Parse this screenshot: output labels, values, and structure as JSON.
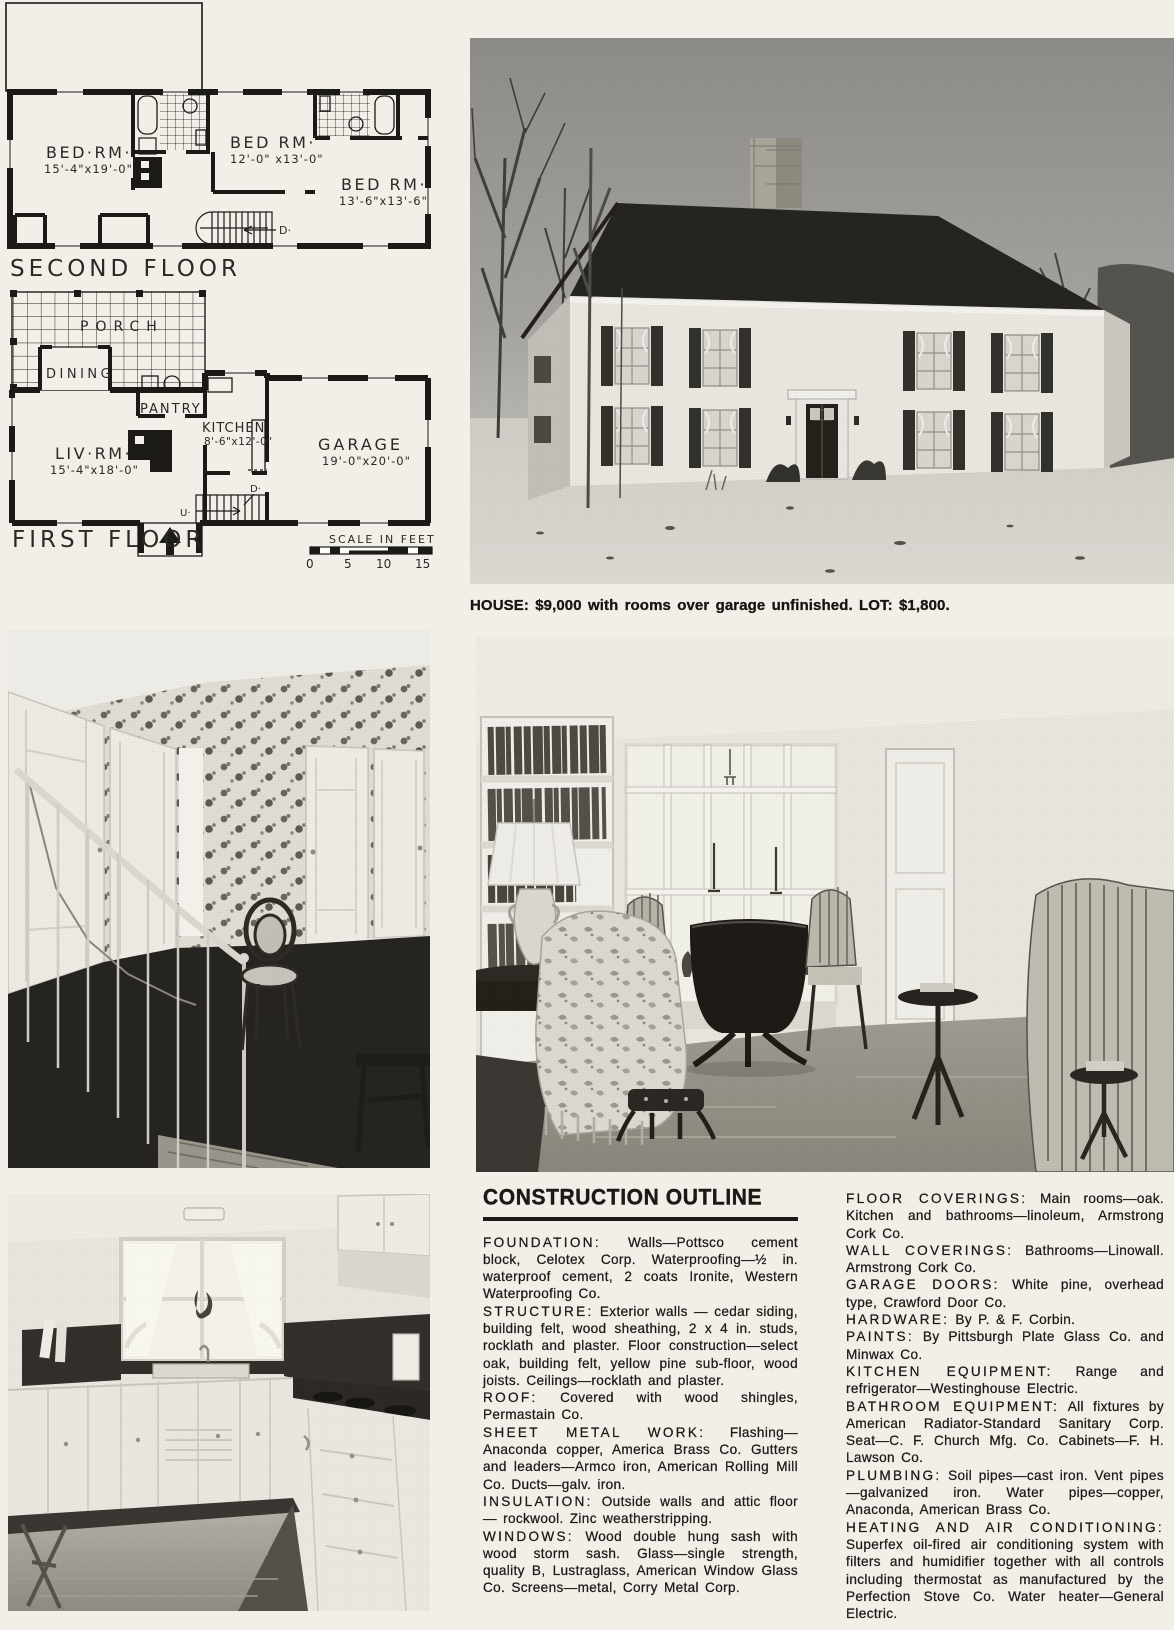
{
  "page": {
    "paper_color": "#f1efe8",
    "ink_color": "#1c1a16"
  },
  "plans": {
    "second_floor": {
      "title": "SECOND FLOOR",
      "bedroom1_name": "BED·RM·",
      "bedroom1_dims": "15'-4\"x19'-0\"",
      "bedroom2_name": "BED RM·",
      "bedroom2_dims": "12'-0\" x13'-0\"",
      "bedroom3_name": "BED RM·",
      "bedroom3_dims": "13'-6\"x13'-6\"",
      "stair_down": "D·"
    },
    "first_floor": {
      "title": "FIRST FLOOR",
      "porch": "PORCH",
      "dining": "DINING",
      "pantry": "PANTRY",
      "kitchen_name": "KITCHEN",
      "kitchen_dims": "8'-6\"x12'-0\"",
      "living_name": "LIV·RM·",
      "living_dims": "15'-4\"x18'-0\"",
      "garage_name": "GARAGE",
      "garage_dims": "19'-0\"x20'-0\"",
      "stair_up": "U·",
      "stair_down": "D·"
    },
    "scale": {
      "label": "SCALE IN FEET",
      "t0": "0",
      "t5": "5",
      "t10": "10",
      "t15": "15"
    }
  },
  "caption": "HOUSE: $9,000 with rooms over garage unfinished. LOT: $1,800.",
  "outline": {
    "title": "CONSTRUCTION OUTLINE",
    "left": [
      {
        "heading": "FOUNDATION:",
        "body": "Walls—Pottsco cement block, Celotex Corp. Waterproofing—½ in. waterproof cement, 2 coats Ironite, Western Waterproofing Co."
      },
      {
        "heading": "STRUCTURE:",
        "body": "Exterior walls — cedar siding, building felt, wood sheathing, 2 x 4 in. studs, rocklath and plaster. Floor construction—select oak, building felt, yellow pine sub-floor, wood joists. Ceilings—rocklath and plaster."
      },
      {
        "heading": "ROOF:",
        "body": "Covered with wood shingles, Permastain Co."
      },
      {
        "heading": "SHEET METAL WORK:",
        "body": "Flashing—Anaconda copper, America Brass Co. Gutters and leaders—Armco iron, American Rolling Mill Co. Ducts—galv. iron."
      },
      {
        "heading": "INSULATION:",
        "body": "Outside walls and attic floor — rockwool. Zinc weatherstripping."
      },
      {
        "heading": "WINDOWS:",
        "body": "Wood double hung sash with wood storm sash. Glass—single strength, quality B, Lustraglass, American Window Glass Co. Screens—metal, Corry Metal Corp."
      }
    ],
    "right": [
      {
        "heading": "FLOOR COVERINGS:",
        "body": "Main rooms—oak. Kitchen and bathrooms—linoleum, Armstrong Cork Co."
      },
      {
        "heading": "WALL COVERINGS:",
        "body": "Bathrooms—Linowall. Armstrong Cork Co."
      },
      {
        "heading": "GARAGE DOORS:",
        "body": "White pine, overhead type, Crawford Door Co."
      },
      {
        "heading": "HARDWARE:",
        "body": "By P. & F. Corbin."
      },
      {
        "heading": "PAINTS:",
        "body": "By Pittsburgh Plate Glass Co. and Minwax Co."
      },
      {
        "heading": "KITCHEN EQUIPMENT:",
        "body": "Range and refrigerator—Westinghouse Electric."
      },
      {
        "heading": "BATHROOM EQUIPMENT:",
        "body": "All fixtures by American Radiator-Standard Sanitary Corp. Seat—C. F. Church Mfg. Co. Cabinets—F. H. Lawson Co."
      },
      {
        "heading": "PLUMBING:",
        "body": "Soil pipes—cast iron. Vent pipes—galvanized iron. Water pipes—copper, Anaconda, American Brass Co."
      },
      {
        "heading": "HEATING AND AIR CONDITIONING:",
        "body": "Superfex oil-fired air conditioning system with filters and humidifier together with all controls including thermostat as manufactured by the Perfection Stove Co. Water heater—General Electric."
      }
    ]
  }
}
